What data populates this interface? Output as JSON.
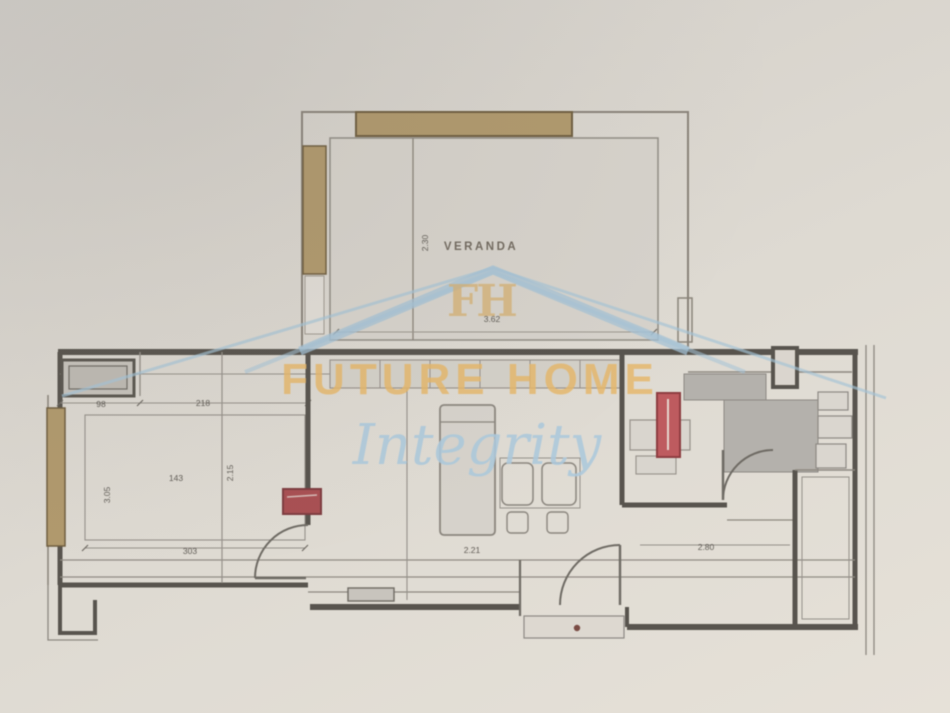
{
  "watermark": {
    "monogram": "FH",
    "brand": "FUTURE HOME",
    "tagline": "Integrity",
    "brand_color": "#e9b969",
    "tagline_color": "#aecbdf",
    "roof_color": "#a5c4d8",
    "monogram_color": "#d8b271"
  },
  "plan": {
    "rooms": {
      "veranda_label": "VERANDA"
    },
    "dims": {
      "veranda_width": "3.62",
      "veranda_depth": "2.30",
      "bedroom_seg1": "98",
      "bedroom_seg2": "218",
      "bedroom_inner_width": "143",
      "bedroom_width": "303",
      "bedroom_depth": "3.05",
      "bedroom_inner_depth": "2.15",
      "living_width": "2.21",
      "hall_width": "2.80"
    },
    "colors": {
      "wall": "#57534c",
      "line": "#8d8880",
      "wood_tan": "#b29a6c",
      "floor_gray": "#b6b3ad",
      "marker_red": "#c05a5e",
      "marker_red_dark": "#a94f52",
      "paper": "#d9d5cd"
    }
  }
}
